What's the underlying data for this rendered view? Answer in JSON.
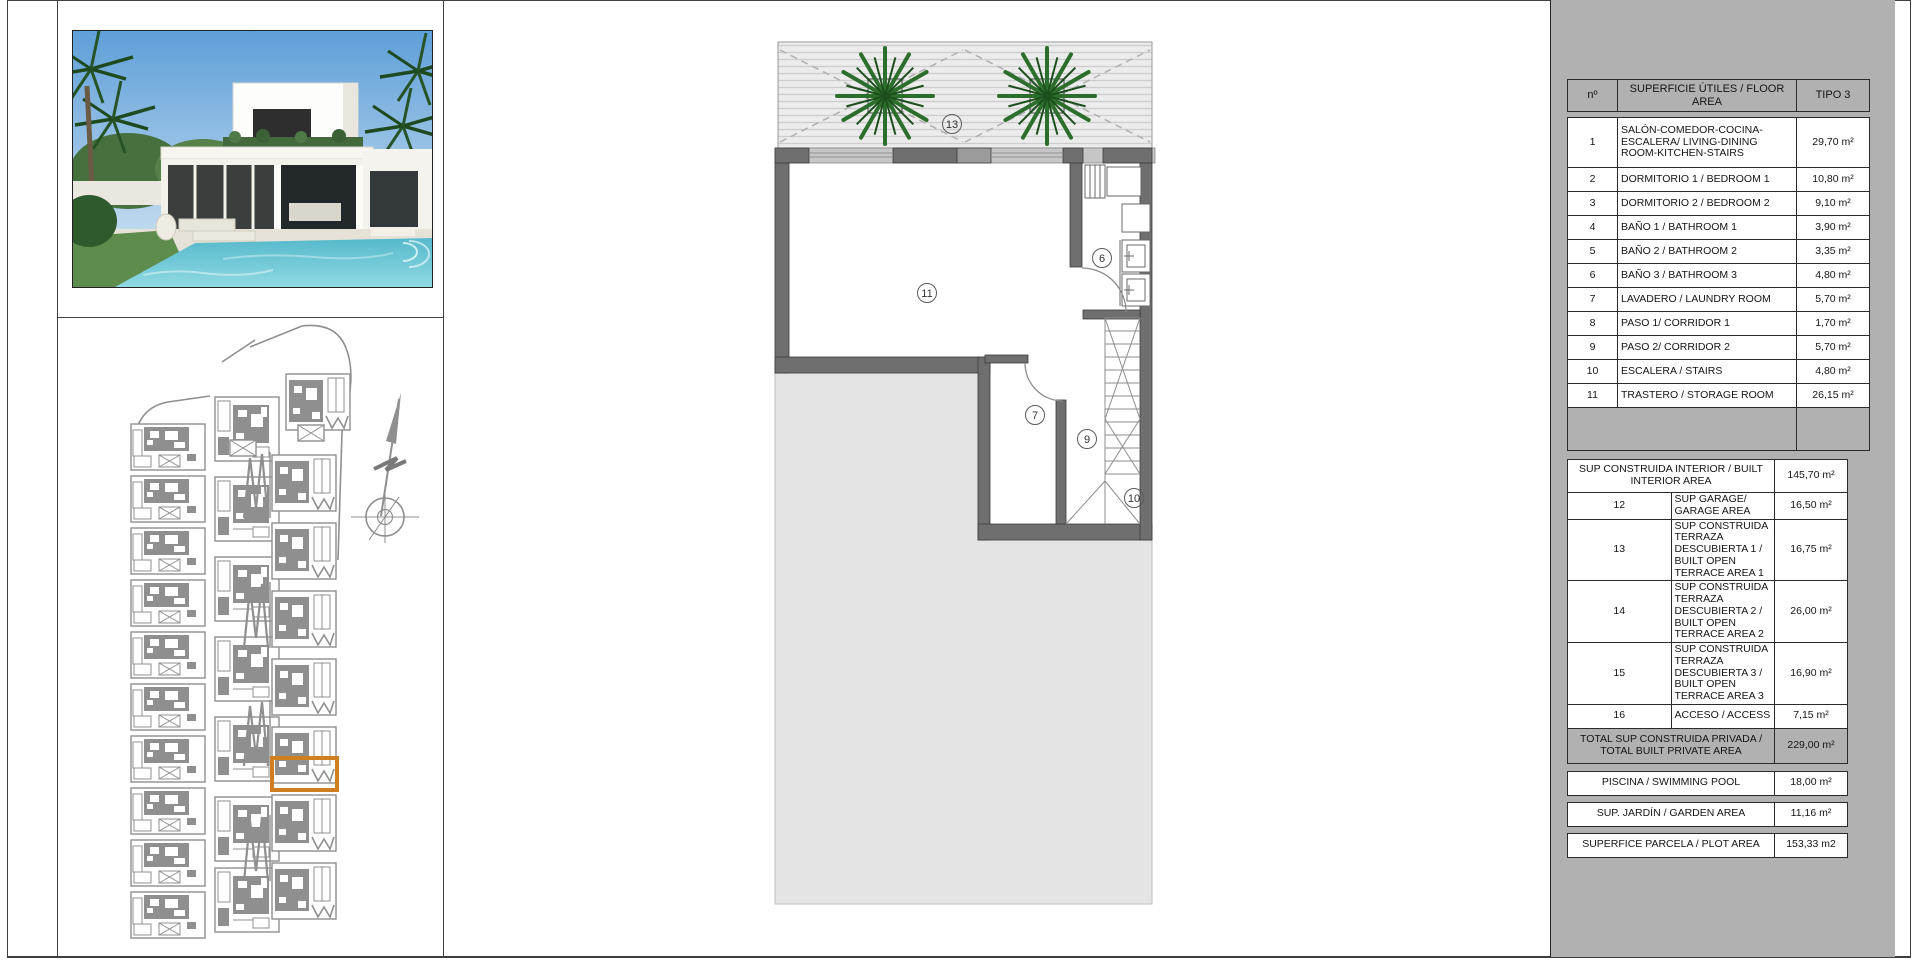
{
  "colors": {
    "panel_gray": "#b1b1b1",
    "highlight_orange": "#cf7f1f",
    "wall_gray": "#6f6f6f",
    "plot_gray": "#e4e4e4",
    "siteplan_gray": "#8f8f8f",
    "tree_green": "#2c6e2c",
    "pool_turquoise": "#62c0cf"
  },
  "floor_plan": {
    "labels": {
      "t13": "13",
      "t11": "11",
      "t6": "6",
      "t7": "7",
      "t9": "9",
      "t10": "10"
    }
  },
  "table": {
    "header": {
      "num": "nº",
      "name": "SUPERFICIE ÚTILES / FLOOR AREA",
      "type": "TIPO 3"
    },
    "rows": [
      {
        "n": "1",
        "label": "SALÓN-COMEDOR-COCINA-ESCALERA/ LIVING-DINING ROOM-KITCHEN-STAIRS",
        "value": "29,70 m²"
      },
      {
        "n": "2",
        "label": "DORMITORIO 1 / BEDROOM 1",
        "value": "10,80 m²"
      },
      {
        "n": "3",
        "label": "DORMITORIO 2 / BEDROOM 2",
        "value": "9,10 m²"
      },
      {
        "n": "4",
        "label": "BAÑO 1 / BATHROOM 1",
        "value": "3,90 m²"
      },
      {
        "n": "5",
        "label": "BAÑO 2 / BATHROOM 2",
        "value": "3,35 m²"
      },
      {
        "n": "6",
        "label": "BAÑO 3 / BATHROOM 3",
        "value": "4,80 m²"
      },
      {
        "n": "7",
        "label": "LAVADERO / LAUNDRY ROOM",
        "value": "5,70 m²"
      },
      {
        "n": "8",
        "label": "PASO 1/ CORRIDOR 1",
        "value": "1,70 m²"
      },
      {
        "n": "9",
        "label": "PASO 2/ CORRIDOR 2",
        "value": "5,70 m²"
      },
      {
        "n": "10",
        "label": "ESCALERA / STAIRS",
        "value": "4,80 m²"
      },
      {
        "n": "11",
        "label": "TRASTERO / STORAGE ROOM",
        "value": "26,15 m²"
      }
    ],
    "interior": {
      "label": "SUP CONSTRUIDA INTERIOR / BUILT INTERIOR AREA",
      "value": "145,70 m²"
    },
    "rows2": [
      {
        "n": "12",
        "label": "SUP GARAGE/ GARAGE AREA",
        "value": "16,50 m²"
      },
      {
        "n": "13",
        "label": "SUP CONSTRUIDA TERRAZA DESCUBIERTA 1 / BUILT OPEN TERRACE AREA 1",
        "value": "16,75 m²"
      },
      {
        "n": "14",
        "label": "SUP CONSTRUIDA TERRAZA DESCUBIERTA 2 / BUILT OPEN TERRACE AREA 2",
        "value": "26,00 m²"
      },
      {
        "n": "15",
        "label": "SUP CONSTRUIDA TERRAZA DESCUBIERTA 3 / BUILT OPEN TERRACE AREA 3",
        "value": "16,90 m²"
      },
      {
        "n": "16",
        "label": "ACCESO / ACCESS",
        "value": "7,15 m²"
      }
    ],
    "total": {
      "label": "TOTAL SUP CONSTRUIDA PRIVADA / TOTAL BUILT PRIVATE AREA",
      "value": "229,00 m²"
    },
    "extra": [
      {
        "label": "PISCINA / SWIMMING POOL",
        "value": "18,00 m²"
      },
      {
        "label": "SUP. JARDÍN / GARDEN AREA",
        "value": "11,16 m²"
      },
      {
        "label": "SUPERFICE PARCELA / PLOT AREA",
        "value": "153,33 m2"
      }
    ]
  }
}
